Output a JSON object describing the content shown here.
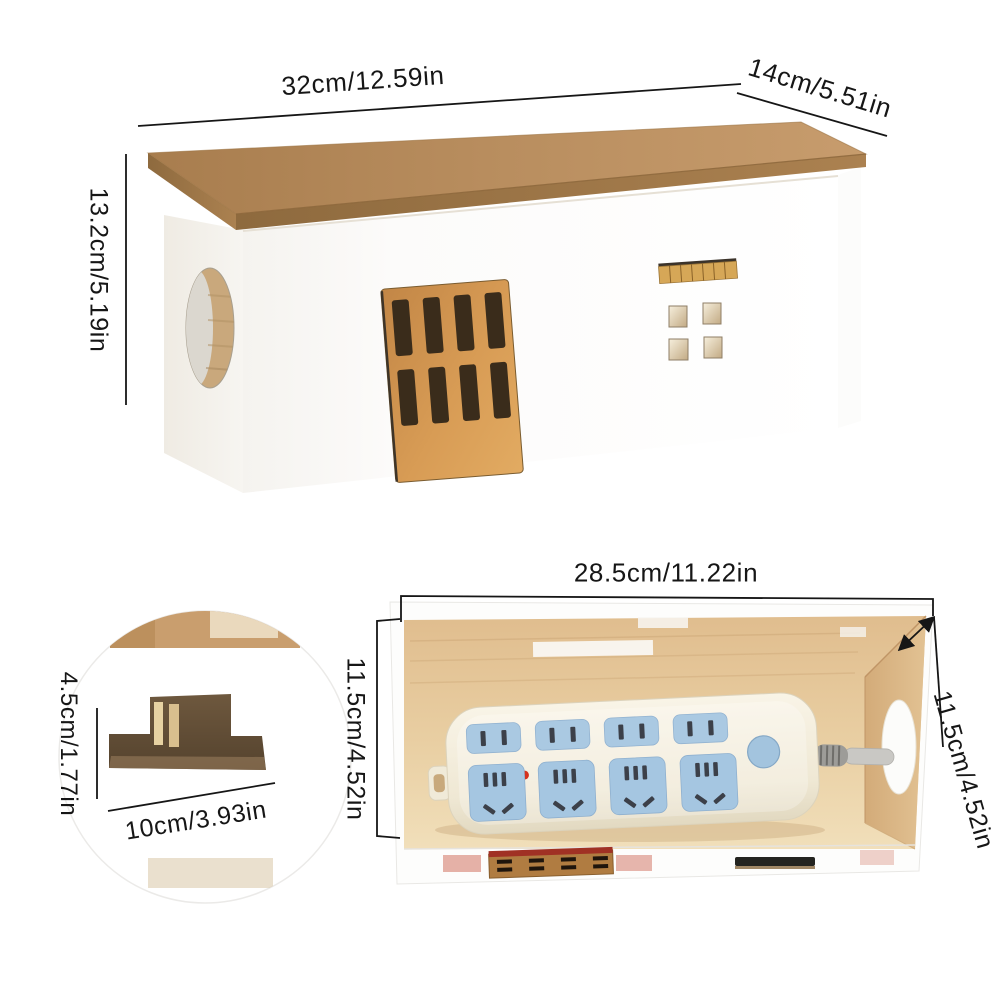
{
  "product_diagram": {
    "exterior_view": {
      "top_width": "32cm/12.59in",
      "top_depth": "14cm/5.51in",
      "side_height": "13.2cm/5.19in"
    },
    "interior_view": {
      "inner_width": "28.5cm/11.22in",
      "inner_height": "11.5cm/4.52in",
      "inner_depth": "11.5cm/4.52in"
    },
    "slot_detail_view": {
      "slot_height": "4.5cm/1.77in",
      "slot_width": "10cm/3.93in"
    },
    "colors": {
      "roof_wood": "#b98e5f",
      "door_wood": "#cf9a55",
      "body_white": "#fbfafa",
      "interior_wood": "#e6c89c",
      "outlet_blue": "#a9c8e2",
      "dimension_ink": "#161616"
    }
  }
}
